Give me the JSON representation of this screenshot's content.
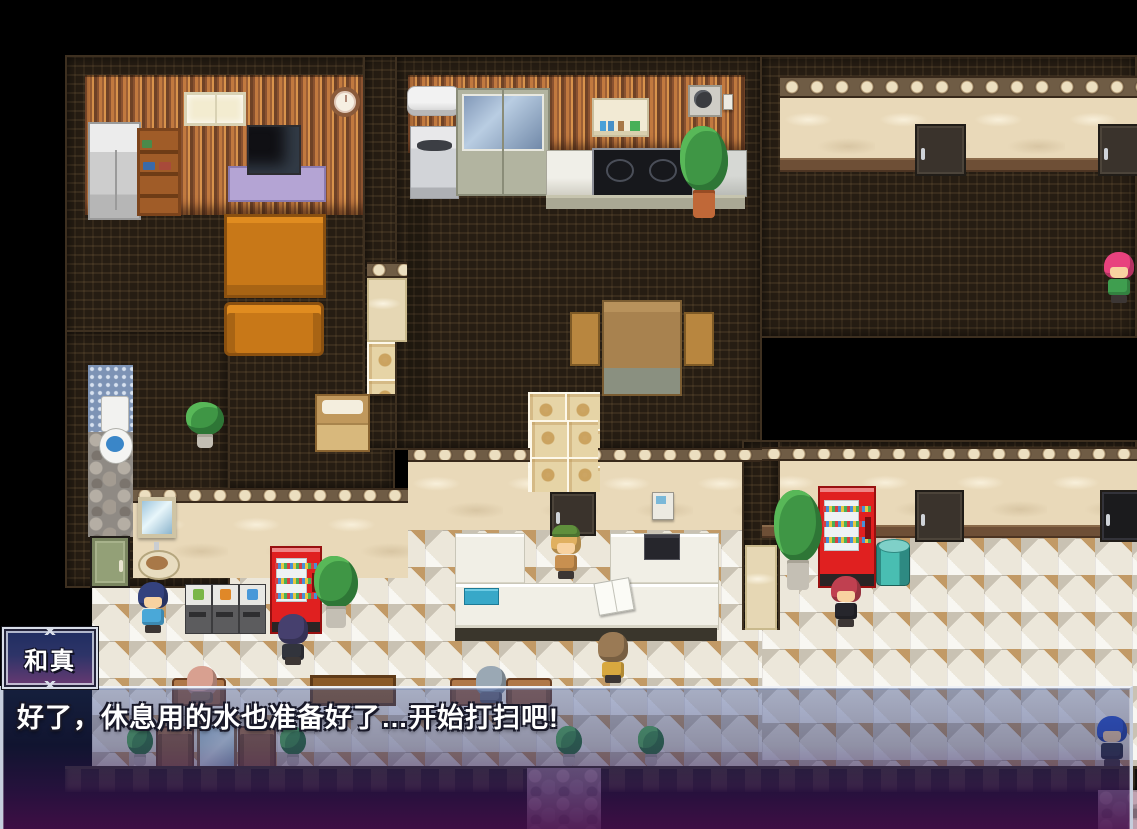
{
  "dialogue": {
    "speaker_name": "和真",
    "message_text": "好了，休息用的水也准备好了…开始打扫吧!"
  },
  "ui": {
    "name_window": {
      "bg_top": "#1f2d60",
      "bg_bottom": "#6a3a72",
      "border": "#d8dde8",
      "text_color": "#ffffff"
    },
    "message_window": {
      "bg_top": "rgba(56,82,160,0.38)",
      "bg_bottom": "rgba(72,16,78,0.88)",
      "border": "#eef1f7",
      "text_color": "#ffffff"
    }
  },
  "scene": {
    "characters": [
      {
        "id": "npc-pink-hair",
        "x": 1102,
        "y": 252,
        "facing": "down",
        "seated": false,
        "hair": "#e8427e",
        "outfit": "#3f9e4f",
        "hat": null
      },
      {
        "id": "npc-blue-kid",
        "x": 136,
        "y": 582,
        "facing": "down",
        "seated": false,
        "hair": "#34427e",
        "outfit": "#4aa8d8",
        "hat": null
      },
      {
        "id": "npc-purple-hair-back",
        "x": 276,
        "y": 614,
        "facing": "up",
        "seated": false,
        "hair": "#46406e",
        "outfit": "#32343c",
        "hat": null
      },
      {
        "id": "npc-receptionist",
        "x": 549,
        "y": 528,
        "facing": "down",
        "seated": false,
        "hair": "#e0b060",
        "outfit": "#c89050",
        "hat": "#5f8f3c"
      },
      {
        "id": "npc-brown-hair-back",
        "x": 596,
        "y": 632,
        "facing": "up",
        "seated": false,
        "hair": "#9a7a55",
        "outfit": "#d8a83f",
        "hat": null
      },
      {
        "id": "npc-red-hair-suit",
        "x": 829,
        "y": 576,
        "facing": "down",
        "seated": false,
        "hair": "#c04050",
        "outfit": "#26262c",
        "hat": null
      },
      {
        "id": "npc-seated-salmon",
        "x": 185,
        "y": 666,
        "facing": "up",
        "seated": true,
        "hair": "#d8a090",
        "outfit": "#8a6a4f",
        "hat": null
      },
      {
        "id": "npc-seated-gray",
        "x": 474,
        "y": 666,
        "facing": "up",
        "seated": true,
        "hair": "#9aa8b4",
        "outfit": "#6a6a72",
        "hat": null
      },
      {
        "id": "npc-blue-hair",
        "x": 1095,
        "y": 716,
        "facing": "down",
        "seated": false,
        "hair": "#2a52c8",
        "outfit": "#2e3440",
        "hat": null
      }
    ]
  }
}
